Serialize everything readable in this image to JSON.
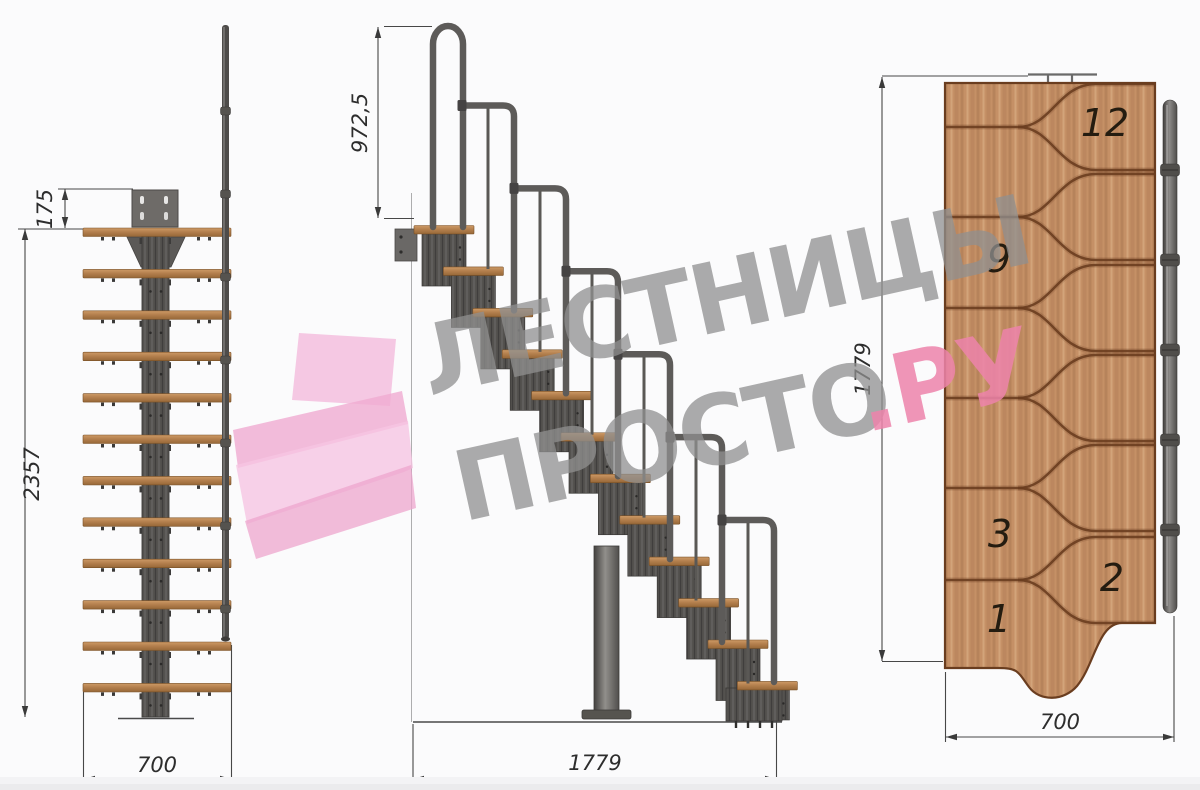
{
  "watermark": {
    "line1": "ЛЕСТНИЦЫ",
    "line2": "ПРОСТО",
    "suffix": ".РУ"
  },
  "views": {
    "front": {
      "dim_offset": "175",
      "dim_height": "2357",
      "dim_width": "700"
    },
    "side": {
      "dim_rail_height": "972,5",
      "dim_length": "1779"
    },
    "top": {
      "dim_length": "1779",
      "dim_width": "700",
      "steps": [
        {
          "label": "12"
        },
        {
          "label": "9"
        },
        {
          "label": "3"
        },
        {
          "label": "2"
        },
        {
          "label": "1"
        }
      ]
    }
  },
  "colors": {
    "wood": "#b5824f",
    "wood_groove": "#6a3d1f",
    "metal": "#54524f",
    "tube": "#5d5b59",
    "dim_line": "#474747",
    "watermark_gray": "#909090",
    "watermark_pink": "#ee84ab",
    "logo_pink": "#f3b9d9"
  }
}
